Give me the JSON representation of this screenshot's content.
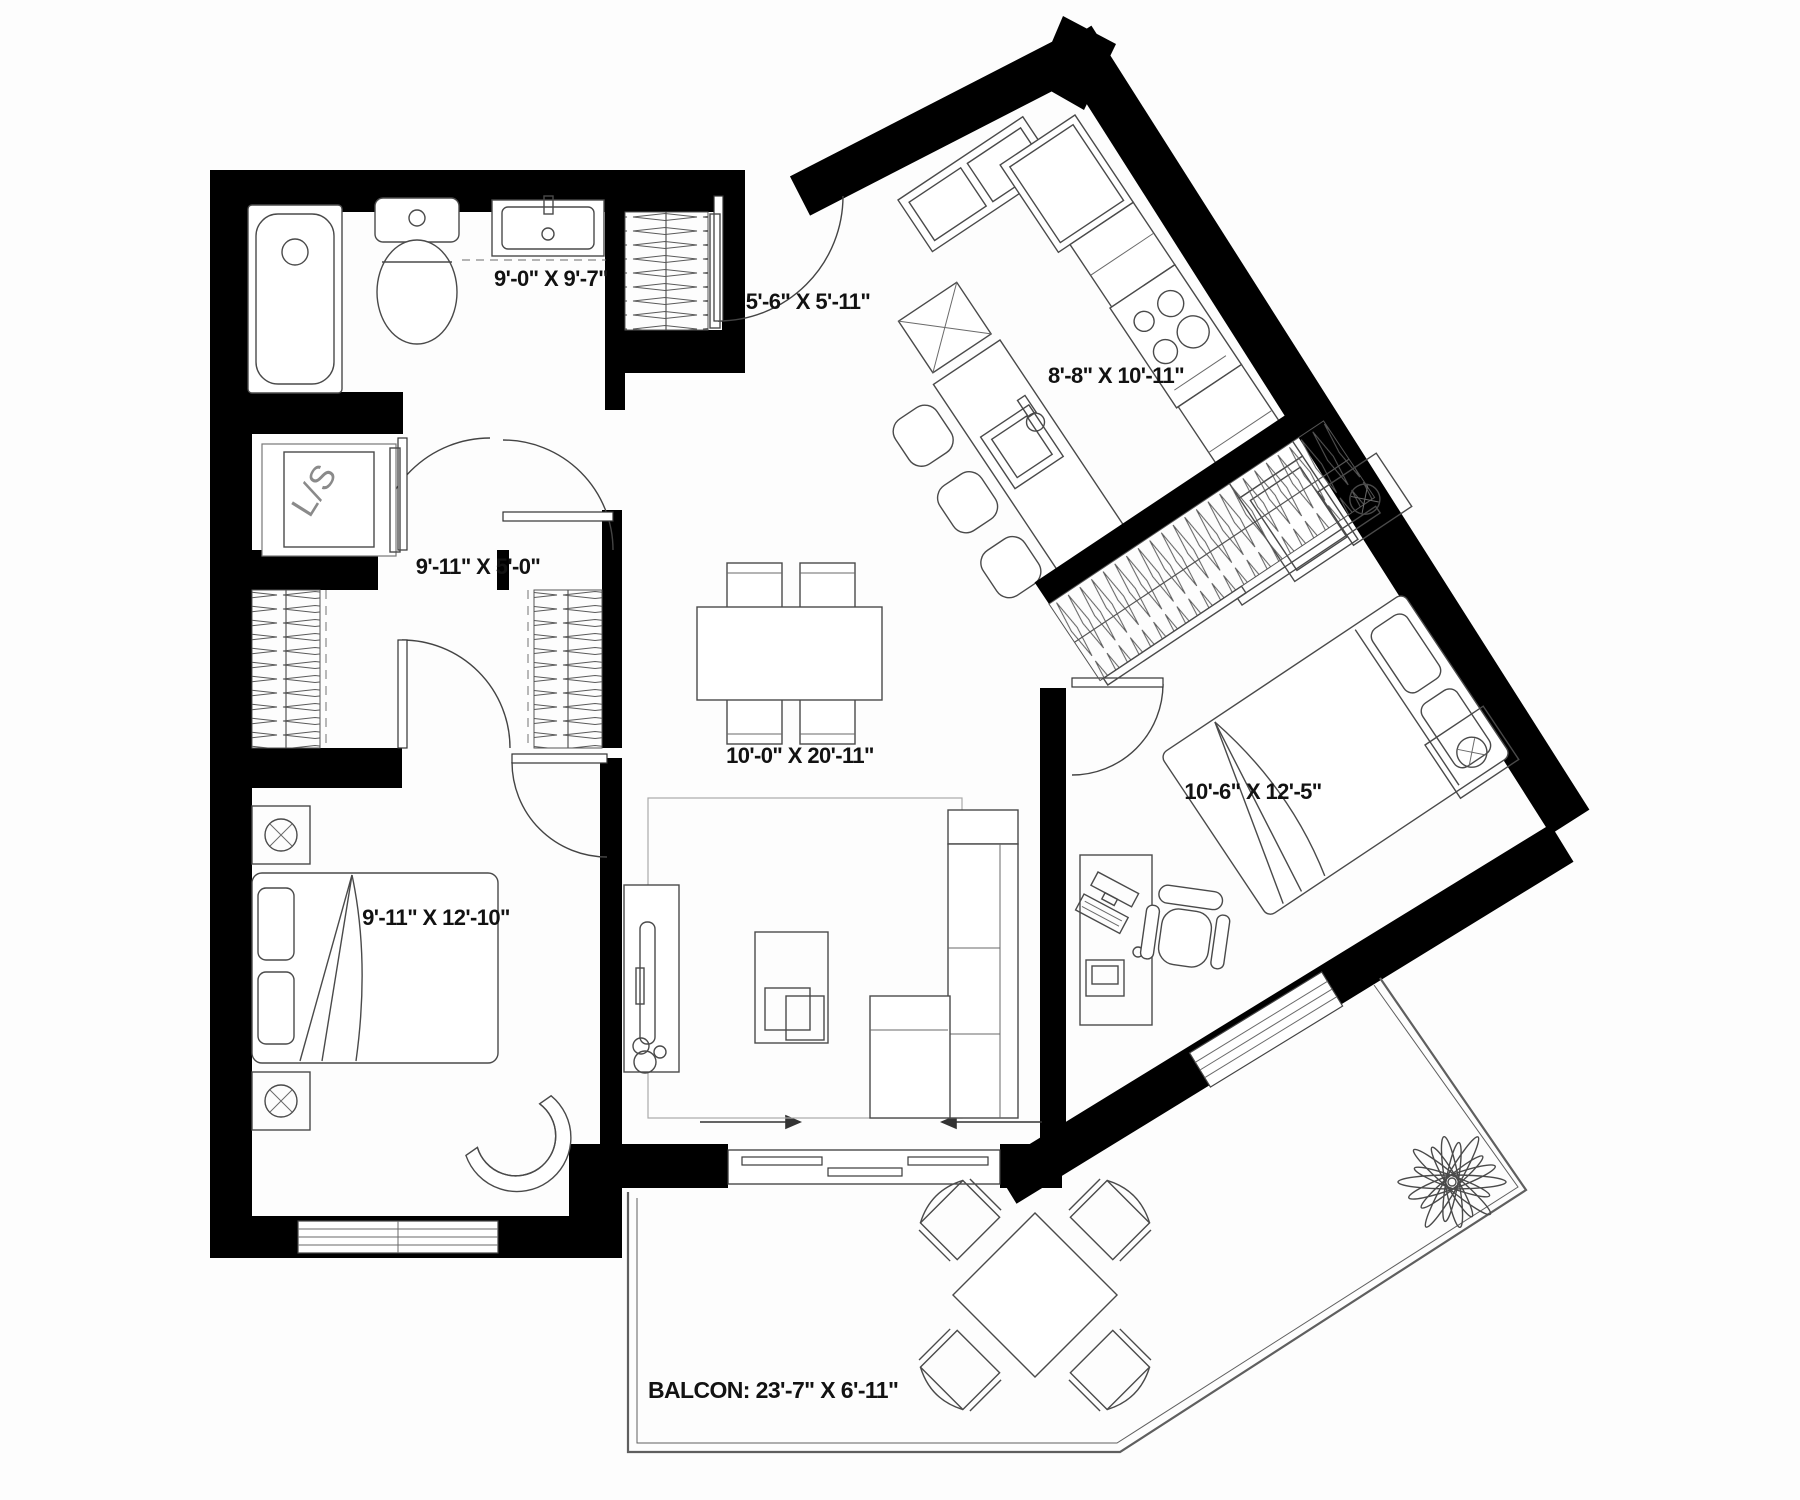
{
  "plan": {
    "bathroom": {
      "dims": "9'-0\" X 9'-7\""
    },
    "entry": {
      "dims": "5'-6\" X 5'-11\""
    },
    "kitchen": {
      "dims": "8'-8\" X 10'-11\""
    },
    "hallway": {
      "dims": "9'-11\" X 5'-0\""
    },
    "living_dining": {
      "dims": "10'-0\" X 20'-11\""
    },
    "bedroom_left": {
      "dims": "9'-11\" X 12'-10\""
    },
    "bedroom_right": {
      "dims": "10'-6\" X 12'-5\""
    },
    "balcony": {
      "label": "BALCON: 23'-7\" X 6'-11\""
    },
    "laundry_storage": {
      "label": "L/S"
    }
  },
  "colors": {
    "wall": "#000000",
    "furniture_line": "#4a4a4a",
    "background": "#ffffff"
  }
}
